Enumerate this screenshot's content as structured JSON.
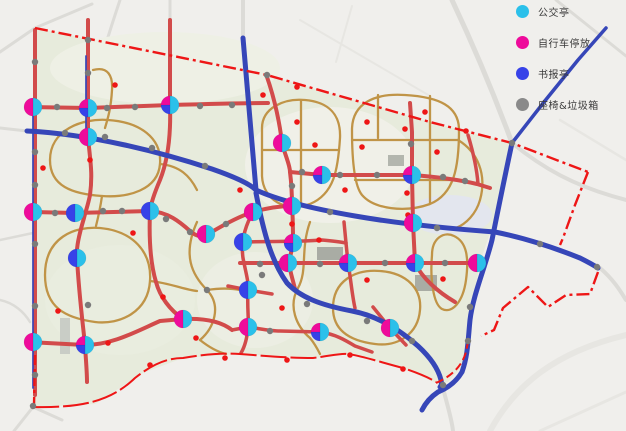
{
  "legend": {
    "items": [
      {
        "label": "公交亭",
        "color": "#2bc0ea"
      },
      {
        "label": "自行车停放",
        "color": "#ee0b9b"
      },
      {
        "label": "书报亭",
        "color": "#3742e8"
      },
      {
        "label": "座椅&垃圾箱",
        "color": "#8a8a8a"
      }
    ]
  },
  "map": {
    "width": 626,
    "height": 431,
    "colors": {
      "bg": "#f0efec",
      "park": "#e7ebdc",
      "context": "#dcdbd7",
      "context_light": "#e7e6e2",
      "road_red": "#d24b4b",
      "road_blue": "#3646b8",
      "path_tan": "#c09447",
      "boundary": "#ee1616",
      "dot_gray": "#7a7a7a",
      "dot_red": "#ee1616",
      "cyan": "#2bc0ea",
      "magenta": "#ee0b9b",
      "blue": "#3742e8"
    },
    "context_roads": [
      {
        "d": "M 452,0 C 478,55 498,105 512,143",
        "w": 5
      },
      {
        "d": "M 512,143 C 545,170 575,185 612,196 L 626,200",
        "w": 4
      },
      {
        "d": "M 0,52 L 35,28 L 92,4",
        "w": 3
      },
      {
        "d": "M 120,0 C 110,30 100,60 95,90",
        "w": 3
      },
      {
        "d": "M 170,0 L 170,22",
        "w": 3
      },
      {
        "d": "M 243,0 L 243,40",
        "w": 4
      },
      {
        "d": "M 556,0 L 626,56",
        "w": 3
      },
      {
        "d": "M 600,268 C 614,280 621,292 626,300",
        "w": 4
      },
      {
        "d": "M 0,128 L 27,131",
        "w": 3
      },
      {
        "d": "M 0,240 L 33,233",
        "w": 2.5
      },
      {
        "d": "M 0,300 C 14,303 24,312 30,322",
        "w": 2.5
      },
      {
        "d": "M 14,431 L 33,407 L 62,420",
        "w": 3
      },
      {
        "d": "M 490,431 C 515,385 555,352 626,335",
        "w": 6,
        "c": "#e7e6e2"
      },
      {
        "d": "M 443,388 C 448,408 452,420 453,431",
        "w": 4
      },
      {
        "d": "M 540,431 L 626,392",
        "w": 3,
        "c": "#e7e6e2"
      },
      {
        "d": "M 300,20 L 430,96",
        "w": 2,
        "c": "#e7e6e2"
      },
      {
        "d": "M 352,6 L 336,62",
        "w": 2,
        "c": "#e7e6e2"
      },
      {
        "d": "M 560,120 L 626,160",
        "w": 2.5,
        "c": "#e7e6e2"
      }
    ],
    "park_outline": [
      [
        35,
        28
      ],
      [
        267,
        75
      ],
      [
        430,
        122
      ],
      [
        512,
        143
      ],
      [
        498,
        210
      ],
      [
        480,
        262
      ],
      [
        470,
        320
      ],
      [
        466,
        362
      ],
      [
        448,
        382
      ],
      [
        436,
        383
      ],
      [
        403,
        368
      ],
      [
        348,
        354
      ],
      [
        313,
        358
      ],
      [
        240,
        354
      ],
      [
        183,
        358
      ],
      [
        143,
        373
      ],
      [
        95,
        404
      ],
      [
        33,
        407
      ]
    ],
    "patches": [
      {
        "t": "e",
        "x": 165,
        "y": 68,
        "rx": 115,
        "ry": 36,
        "f": "#eef0e5"
      },
      {
        "t": "e",
        "x": 330,
        "y": 165,
        "rx": 85,
        "ry": 58,
        "f": "#f0f0e8"
      },
      {
        "t": "e",
        "x": 120,
        "y": 300,
        "rx": 75,
        "ry": 55,
        "f": "#e9eddf"
      },
      {
        "t": "e",
        "x": 255,
        "y": 300,
        "rx": 58,
        "ry": 48,
        "f": "#eceee3"
      },
      {
        "t": "e",
        "x": 450,
        "y": 215,
        "rx": 42,
        "ry": 20,
        "f": "#e3e6ee"
      },
      {
        "t": "r",
        "x": 317,
        "y": 247,
        "w": 26,
        "h": 13,
        "f": "#a9aca4"
      },
      {
        "t": "r",
        "x": 415,
        "y": 275,
        "w": 22,
        "h": 16,
        "f": "#a9aca4"
      },
      {
        "t": "r",
        "x": 388,
        "y": 155,
        "w": 16,
        "h": 11,
        "f": "#b3b6ae"
      },
      {
        "t": "r",
        "x": 60,
        "y": 318,
        "w": 10,
        "h": 36,
        "f": "#c9cdc6"
      }
    ],
    "tan_paths": [
      "M 50,160 C 50,130 82,118 108,120 C 140,122 162,138 160,164 C 158,190 128,198 102,196 C 72,194 50,186 50,160 Z",
      "M 45,275 C 45,237 75,226 100,228 C 133,231 152,252 150,281 C 148,312 120,325 95,322 C 66,318 45,308 45,275 Z",
      "M 197,222 C 182,255 192,275 207,290 C 222,306 214,328 200,340",
      "M 310,222 C 300,250 308,270 298,288 C 288,306 296,326 310,338",
      "M 333,308 C 333,281 355,269 380,271 C 407,273 422,289 420,310 C 418,334 398,347 375,344 C 351,341 333,331 333,308 Z",
      "M 262,128 C 262,108 284,98 305,100 C 329,102 341,115 340,138 C 338,170 334,194 310,204 C 286,213 263,200 262,176 Z",
      "M 301,100 L 301,204",
      "M 262,150 L 339,150",
      "M 352,130 C 352,103 375,93 405,95 C 439,97 459,106 459,130 C 459,168 454,194 430,204 C 405,213 374,209 362,195 C 353,184 352,150 352,130 Z",
      "M 352,140 L 459,140",
      "M 355,180 L 452,180",
      "M 430,96 L 430,203",
      "M 378,95 L 378,138",
      "M 432,255 C 432,238 444,231 454,236 C 467,242 469,258 466,280 C 463,302 452,314 442,309 C 433,304 430,278 432,255 Z",
      "M 458,140 C 478,152 487,175 480,200 C 476,214 466,224 456,228",
      "M 93,70 C 108,66 113,76 112,90 C 111,108 108,118 105,128",
      "M 160,164 C 180,166 190,176 197,190",
      "M 150,281 C 170,283 185,290 197,291",
      "M 102,196 C 100,210 98,218 96,226",
      "M 207,290 C 220,288 230,288 240,290",
      "M 200,340 C 210,348 218,352 226,354",
      "M 310,338 C 315,344 318,350 320,354"
    ],
    "red_roads": [
      {
        "d": "M 35,30 L 35,395",
        "w": 4
      },
      {
        "d": "M 88,20 L 88,137 C 90,160 93,172 90,195 C 88,205 86,210 84,218 C 79,235 76,248 77,258 C 79,295 83,325 85,345 C 86,362 87,372 87,382",
        "w": 4
      },
      {
        "d": "M 170,20 L 170,105 C 171,135 168,160 160,180 C 154,194 151,203 150,211 C 149,235 150,262 156,282 C 160,297 170,310 183,319",
        "w": 4
      },
      {
        "d": "M 28,107 L 88,108 L 170,105 C 205,104 240,103 268,103",
        "w": 4
      },
      {
        "d": "M 33,212 L 75,213 L 150,211 C 168,212 180,222 190,231 C 198,238 203,237 210,233 C 225,224 240,216 253,212 C 267,208 280,206 292,206",
        "w": 4
      },
      {
        "d": "M 290,172 L 322,175 L 412,175 C 440,177 460,180 477,184 L 490,188",
        "w": 4
      },
      {
        "d": "M 240,263 L 288,263 L 348,263 L 415,263 L 477,263",
        "w": 4
      },
      {
        "d": "M 253,212 C 244,228 241,244 243,258 C 246,274 249,282 248,292 C 247,308 249,318 248,327 C 247,340 244,348 241,353",
        "w": 3.5
      },
      {
        "d": "M 267,77 C 275,100 280,125 282,143 C 286,158 290,165 290,172 C 292,188 292,196 292,206 C 293,218 293,230 293,243 C 292,250 290,256 289,263 C 290,272 293,280 295,289",
        "w": 4
      },
      {
        "d": "M 243,242 C 270,241 300,242 322,240 C 333,241 341,242 346,243",
        "w": 3.5
      },
      {
        "d": "M 410,103 L 412,132 L 412,175 L 413,223 L 415,263 C 422,278 438,292 455,302",
        "w": 4
      },
      {
        "d": "M 344,222 L 346,243 L 348,263 C 351,280 352,295 355,308",
        "w": 3.5
      },
      {
        "d": "M 232,330 L 248,327 C 262,329 270,331 280,331 L 320,332 C 335,334 345,340 355,346 L 372,352",
        "w": 3.5
      },
      {
        "d": "M 228,286 L 248,290 L 272,294",
        "w": 3.5
      },
      {
        "d": "M 373,307 L 390,328 L 406,345",
        "w": 3.5
      },
      {
        "d": "M 28,342 L 85,345 C 112,345 135,332 160,321 L 183,319 C 205,318 222,322 232,330",
        "w": 4
      },
      {
        "d": "M 468,135 C 474,155 477,170 478,184",
        "w": 3.5
      }
    ],
    "blue_roads": [
      {
        "d": "M 243,38 C 247,90 252,140 256,190",
        "w": 5
      },
      {
        "d": "M 27,131 C 90,134 160,152 212,169 C 235,177 250,184 256,190",
        "w": 5
      },
      {
        "d": "M 256,190 C 280,201 320,210 355,216 C 395,223 440,228 495,232 C 525,238 555,248 580,258 C 590,263 595,266 598,268",
        "w": 5
      },
      {
        "d": "M 512,143 C 503,185 497,215 492,240 C 485,268 473,295 470,320 C 468,340 468,355 462,372 C 456,382 448,388 438,392 C 432,396 426,402 422,410",
        "w": 5
      },
      {
        "d": "M 256,193 C 264,235 272,262 287,283 C 300,297 320,305 352,311 C 378,316 400,330 418,346 C 430,357 438,368 441,380 C 442,384 441,386 440,387",
        "w": 5
      },
      {
        "d": "M 512,143 L 544,102 L 578,60 L 606,28",
        "w": 3.5
      },
      {
        "d": "M 33,112 L 33,388",
        "w": 1.7
      },
      {
        "d": "M 86,56 L 86,136",
        "w": 1.7
      }
    ],
    "boundary_paths": [
      {
        "d": "M 35,28 L 267,75 L 430,122 L 512,143 L 588,172",
        "w": 2.4,
        "dash": "13 4 3 4"
      },
      {
        "d": "M 588,172 L 575,205 L 563,238 L 560,245",
        "w": 2.4,
        "dash": "13 4 3 4"
      },
      {
        "d": "M 598,272 L 590,294 L 566,295 L 548,307 L 528,287 L 503,308 L 494,330 L 481,336",
        "w": 2.4,
        "dash": "13 4 3 4"
      },
      {
        "d": "M 33,407 C 80,408 110,402 135,378 C 155,362 170,358 183,358 C 205,354 225,353 240,354 C 265,356 290,358 313,358 C 330,356 340,353 348,354 C 362,356 380,362 403,368 C 415,372 428,377 436,382",
        "w": 2,
        "dash": "26 4"
      },
      {
        "d": "M 436,383 C 452,376 462,366 466,352 L 468,342",
        "w": 2,
        "dash": "8 4"
      },
      {
        "d": "M 35,355 L 34,406",
        "w": 2.4,
        "dash": "10 4 3 4"
      }
    ],
    "gray_dots": [
      [
        57,
        107
      ],
      [
        107,
        108
      ],
      [
        135,
        107
      ],
      [
        200,
        106
      ],
      [
        232,
        105
      ],
      [
        88,
        40
      ],
      [
        267,
        75
      ],
      [
        512,
        143
      ],
      [
        597,
        267
      ],
      [
        35,
        62
      ],
      [
        35,
        152
      ],
      [
        35,
        185
      ],
      [
        35,
        244
      ],
      [
        35,
        306
      ],
      [
        35,
        375
      ],
      [
        33,
        406
      ],
      [
        55,
        213
      ],
      [
        103,
        211
      ],
      [
        122,
        211
      ],
      [
        166,
        219
      ],
      [
        190,
        232
      ],
      [
        226,
        224
      ],
      [
        302,
        172
      ],
      [
        340,
        175
      ],
      [
        377,
        175
      ],
      [
        443,
        177
      ],
      [
        465,
        181
      ],
      [
        260,
        264
      ],
      [
        320,
        264
      ],
      [
        385,
        263
      ],
      [
        445,
        263
      ],
      [
        65,
        133
      ],
      [
        105,
        137
      ],
      [
        152,
        148
      ],
      [
        205,
        166
      ],
      [
        330,
        212
      ],
      [
        437,
        228
      ],
      [
        470,
        307
      ],
      [
        468,
        341
      ],
      [
        262,
        275
      ],
      [
        307,
        304
      ],
      [
        367,
        321
      ],
      [
        412,
        341
      ],
      [
        443,
        385
      ],
      [
        540,
        244
      ],
      [
        270,
        331
      ],
      [
        88,
        73
      ],
      [
        292,
        186
      ],
      [
        411,
        144
      ],
      [
        207,
        290
      ],
      [
        88,
        305
      ]
    ],
    "red_dots": [
      [
        115,
        85
      ],
      [
        297,
        87
      ],
      [
        263,
        95
      ],
      [
        405,
        129
      ],
      [
        437,
        152
      ],
      [
        297,
        122
      ],
      [
        315,
        145
      ],
      [
        362,
        147
      ],
      [
        367,
        122
      ],
      [
        319,
        240
      ],
      [
        292,
        224
      ],
      [
        407,
        193
      ],
      [
        408,
        215
      ],
      [
        345,
        190
      ],
      [
        367,
        280
      ],
      [
        443,
        279
      ],
      [
        108,
        343
      ],
      [
        58,
        311
      ],
      [
        43,
        168
      ],
      [
        133,
        233
      ],
      [
        240,
        190
      ],
      [
        225,
        358
      ],
      [
        287,
        360
      ],
      [
        350,
        355
      ],
      [
        403,
        369
      ],
      [
        150,
        365
      ],
      [
        163,
        297
      ],
      [
        90,
        160
      ],
      [
        466,
        131
      ],
      [
        196,
        338
      ],
      [
        282,
        308
      ],
      [
        425,
        112
      ]
    ],
    "node_types": {
      "mc": [
        [
          "cyan",
          -90,
          90
        ],
        [
          "magenta",
          90,
          270
        ]
      ],
      "bc": [
        [
          "cyan",
          -90,
          90
        ],
        [
          "blue",
          90,
          270
        ]
      ],
      "mbc": [
        [
          "cyan",
          -90,
          90
        ],
        [
          "blue",
          90,
          180
        ],
        [
          "magenta",
          180,
          270
        ]
      ]
    },
    "facility_nodes": [
      [
        33,
        107,
        "mc"
      ],
      [
        88,
        108,
        "mbc"
      ],
      [
        170,
        105,
        "mbc"
      ],
      [
        88,
        137,
        "mc"
      ],
      [
        282,
        143,
        "mc"
      ],
      [
        322,
        175,
        "mbc"
      ],
      [
        412,
        175,
        "mbc"
      ],
      [
        33,
        212,
        "mc"
      ],
      [
        75,
        213,
        "bc"
      ],
      [
        150,
        211,
        "bc"
      ],
      [
        206,
        234,
        "mc"
      ],
      [
        253,
        212,
        "mc"
      ],
      [
        292,
        206,
        "mc"
      ],
      [
        243,
        242,
        "bc"
      ],
      [
        293,
        243,
        "mbc"
      ],
      [
        413,
        223,
        "mc"
      ],
      [
        288,
        263,
        "mc"
      ],
      [
        348,
        263,
        "mbc"
      ],
      [
        415,
        263,
        "mbc"
      ],
      [
        477,
        263,
        "mc"
      ],
      [
        248,
        290,
        "bc"
      ],
      [
        77,
        258,
        "bc"
      ],
      [
        183,
        319,
        "mc"
      ],
      [
        248,
        327,
        "mc"
      ],
      [
        320,
        332,
        "mbc"
      ],
      [
        390,
        328,
        "mc"
      ],
      [
        33,
        342,
        "mc"
      ],
      [
        85,
        345,
        "mbc"
      ]
    ],
    "node_radius": 9
  }
}
